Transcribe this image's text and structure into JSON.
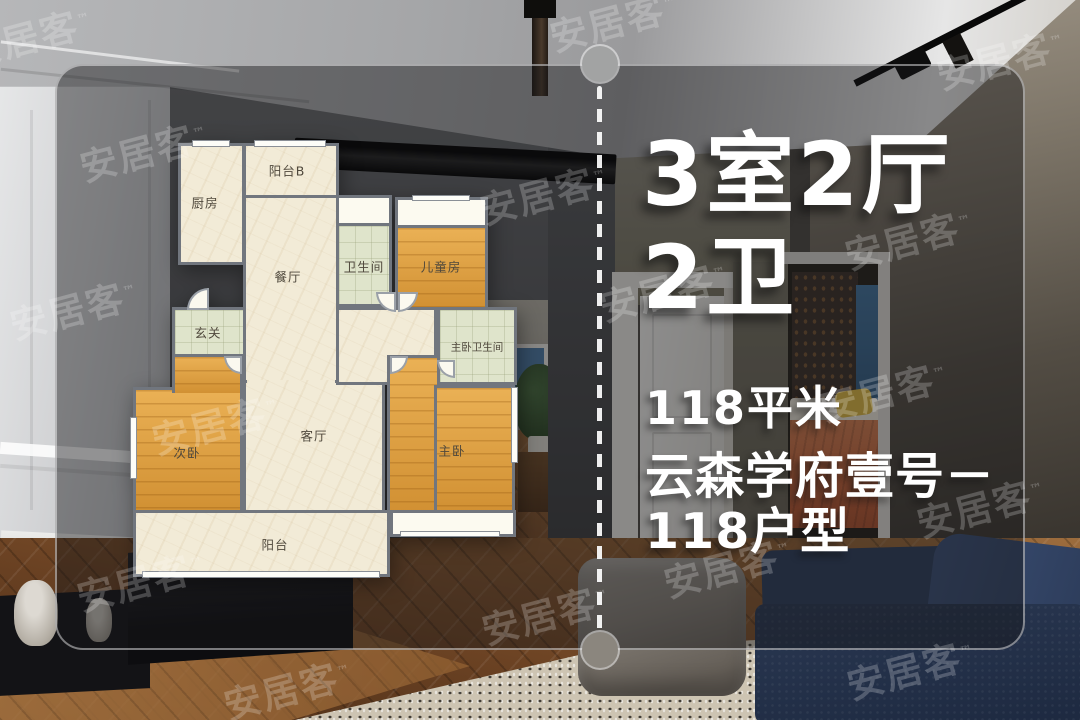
{
  "watermark": {
    "text": "安居客",
    "tm": "™"
  },
  "floorplan": {
    "rooms": [
      {
        "id": "kitchen",
        "label": "厨房"
      },
      {
        "id": "balcony-b",
        "label": "阳台B"
      },
      {
        "id": "dining-room",
        "label": "餐厅"
      },
      {
        "id": "bathroom",
        "label": "卫生间"
      },
      {
        "id": "kids-room",
        "label": "儿童房"
      },
      {
        "id": "foyer",
        "label": "玄关"
      },
      {
        "id": "master-bathroom",
        "label": "主卧卫生间"
      },
      {
        "id": "second-bedroom",
        "label": "次卧"
      },
      {
        "id": "living-room",
        "label": "客厅"
      },
      {
        "id": "master-bedroom",
        "label": "主卧"
      },
      {
        "id": "balcony",
        "label": "阳台"
      }
    ]
  },
  "info": {
    "layout_line1": "3室2厅",
    "layout_line2": "2卫",
    "area": "118平米",
    "project_line1": "云森学府壹号－",
    "project_line2": "118户型"
  },
  "colors": {
    "text": "#ffffff",
    "floor_cream": "#f2ebd7",
    "floor_wood_orange": "#e2a03c",
    "tile_green": "#dfe4cb",
    "wall_gray": "#71767e",
    "overlay_tint": "rgba(22,23,25,0.45)"
  }
}
